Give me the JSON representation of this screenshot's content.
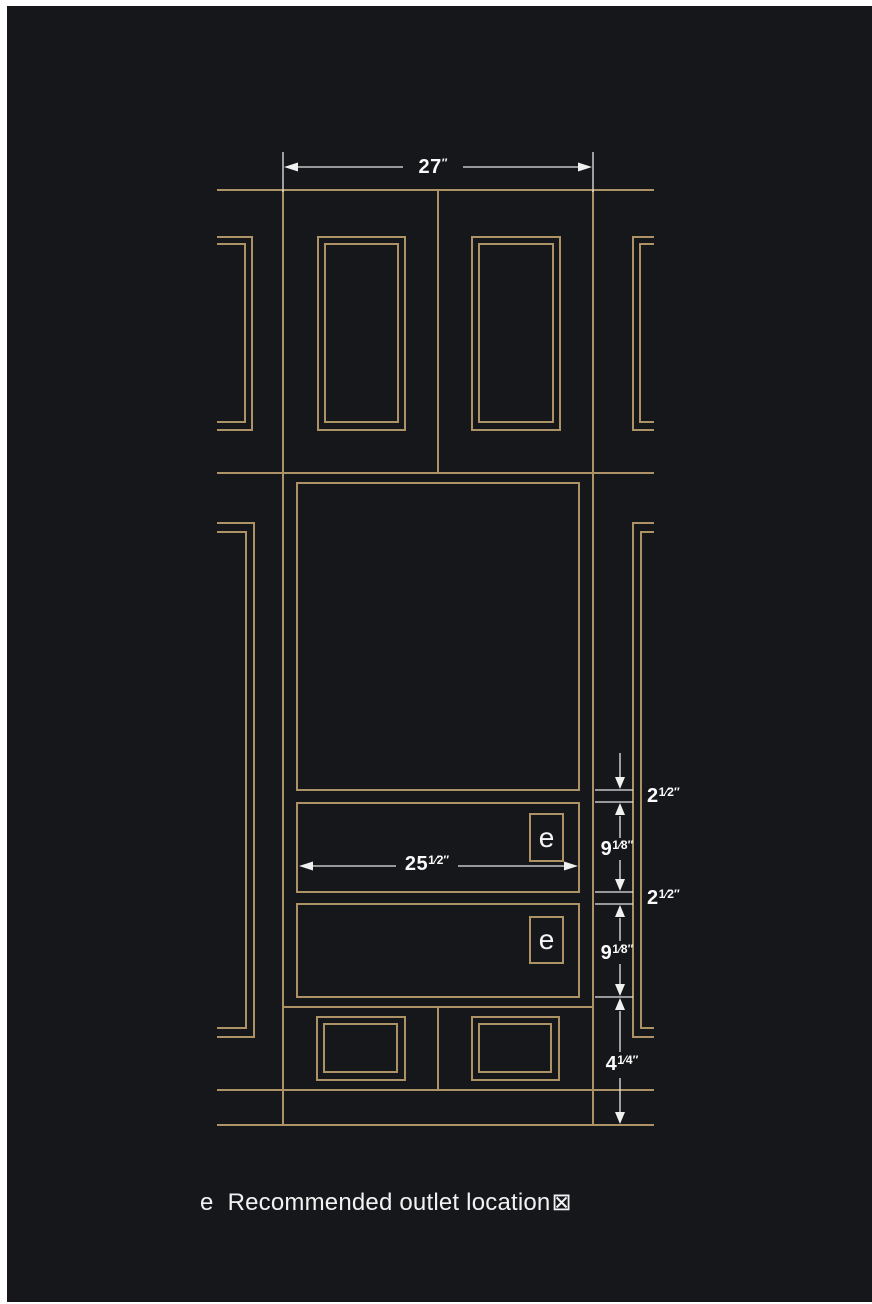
{
  "page": {
    "background": "#ffffff",
    "canvas_background": "#16171a"
  },
  "colors": {
    "line_gold": "#ad9265",
    "dimension_line": "#e6e6e6",
    "text_white": "#fafafa"
  },
  "drawing": {
    "type": "wall-paneling-millwork-elevation",
    "dimensions": {
      "top_width": {
        "base": "27",
        "sup": "″"
      },
      "panel_width": {
        "base": "25",
        "sup": "1⁄2″"
      },
      "right_column": [
        {
          "base": "2",
          "sup": "1⁄2″"
        },
        {
          "base": "9",
          "sup": "1⁄8″"
        },
        {
          "base": "2",
          "sup": "1⁄2″"
        },
        {
          "base": "9",
          "sup": "1⁄8″"
        },
        {
          "base": "4",
          "sup": "1⁄4″"
        }
      ]
    },
    "outlet_markers": [
      {
        "label": "e"
      },
      {
        "label": "e"
      }
    ],
    "legend": {
      "symbol": "e",
      "text": "Recommended outlet location",
      "missing_glyph": "⊠"
    }
  }
}
